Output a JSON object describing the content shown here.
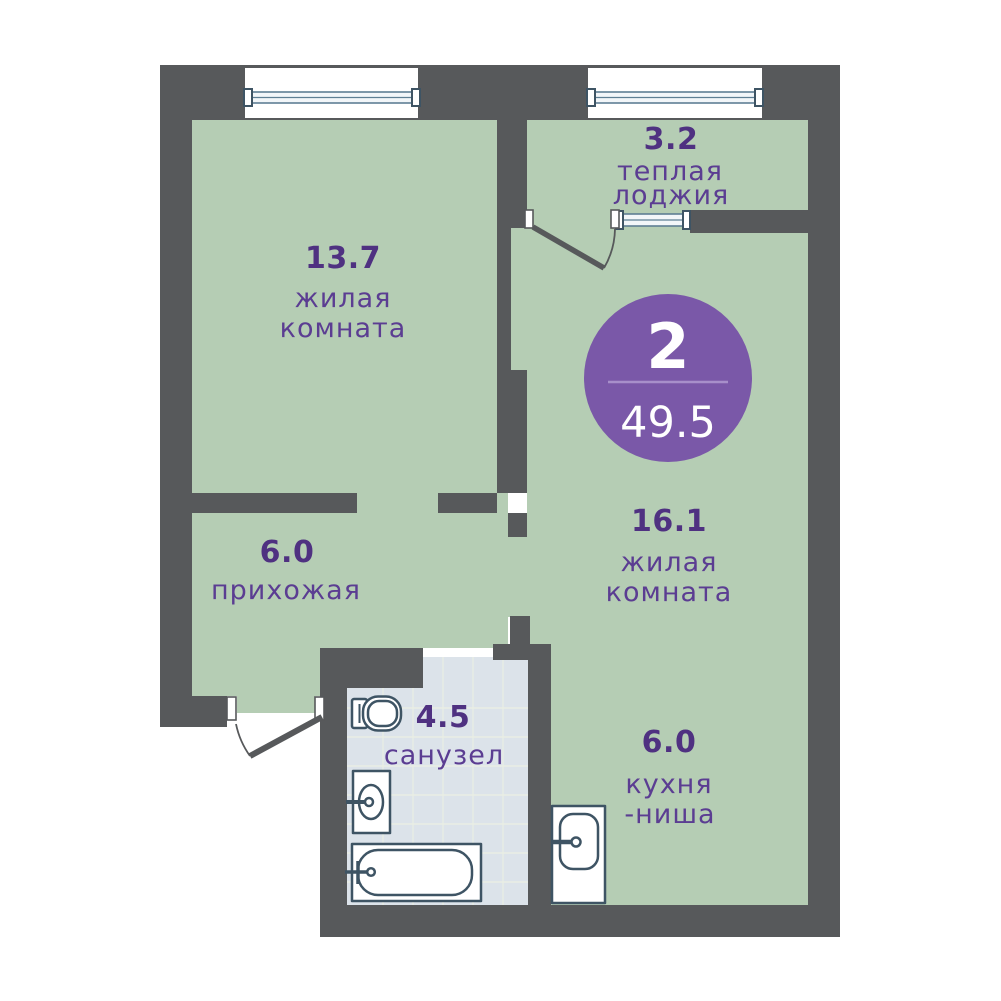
{
  "plan": {
    "badge": {
      "rooms_count": "2",
      "total_area": "49.5"
    },
    "rooms": [
      {
        "id": "living-room-1",
        "area": "13.7",
        "name_lines": [
          "жилая",
          "комната"
        ]
      },
      {
        "id": "warm-loggia",
        "area": "3.2",
        "name_lines": [
          "теплая",
          "лоджия"
        ]
      },
      {
        "id": "living-room-2",
        "area": "16.1",
        "name_lines": [
          "жилая",
          "комната"
        ]
      },
      {
        "id": "hallway",
        "area": "6.0",
        "name_lines": [
          "прихожая"
        ]
      },
      {
        "id": "bathroom",
        "area": "4.5",
        "name_lines": [
          "санузел"
        ]
      },
      {
        "id": "kitchen-niche",
        "area": "6.0",
        "name_lines": [
          "кухня",
          "-ниша"
        ]
      }
    ],
    "colors": {
      "wall": "#57595b",
      "room_floor": "#b5cdb4",
      "bathroom_floor": "#dce3ea",
      "badge_accent": "#7a58a8",
      "area_text": "#4f3181",
      "label_text": "#5b3d92",
      "fixture_stroke": "#3e5464",
      "window_frame": "#5e7f94"
    }
  }
}
